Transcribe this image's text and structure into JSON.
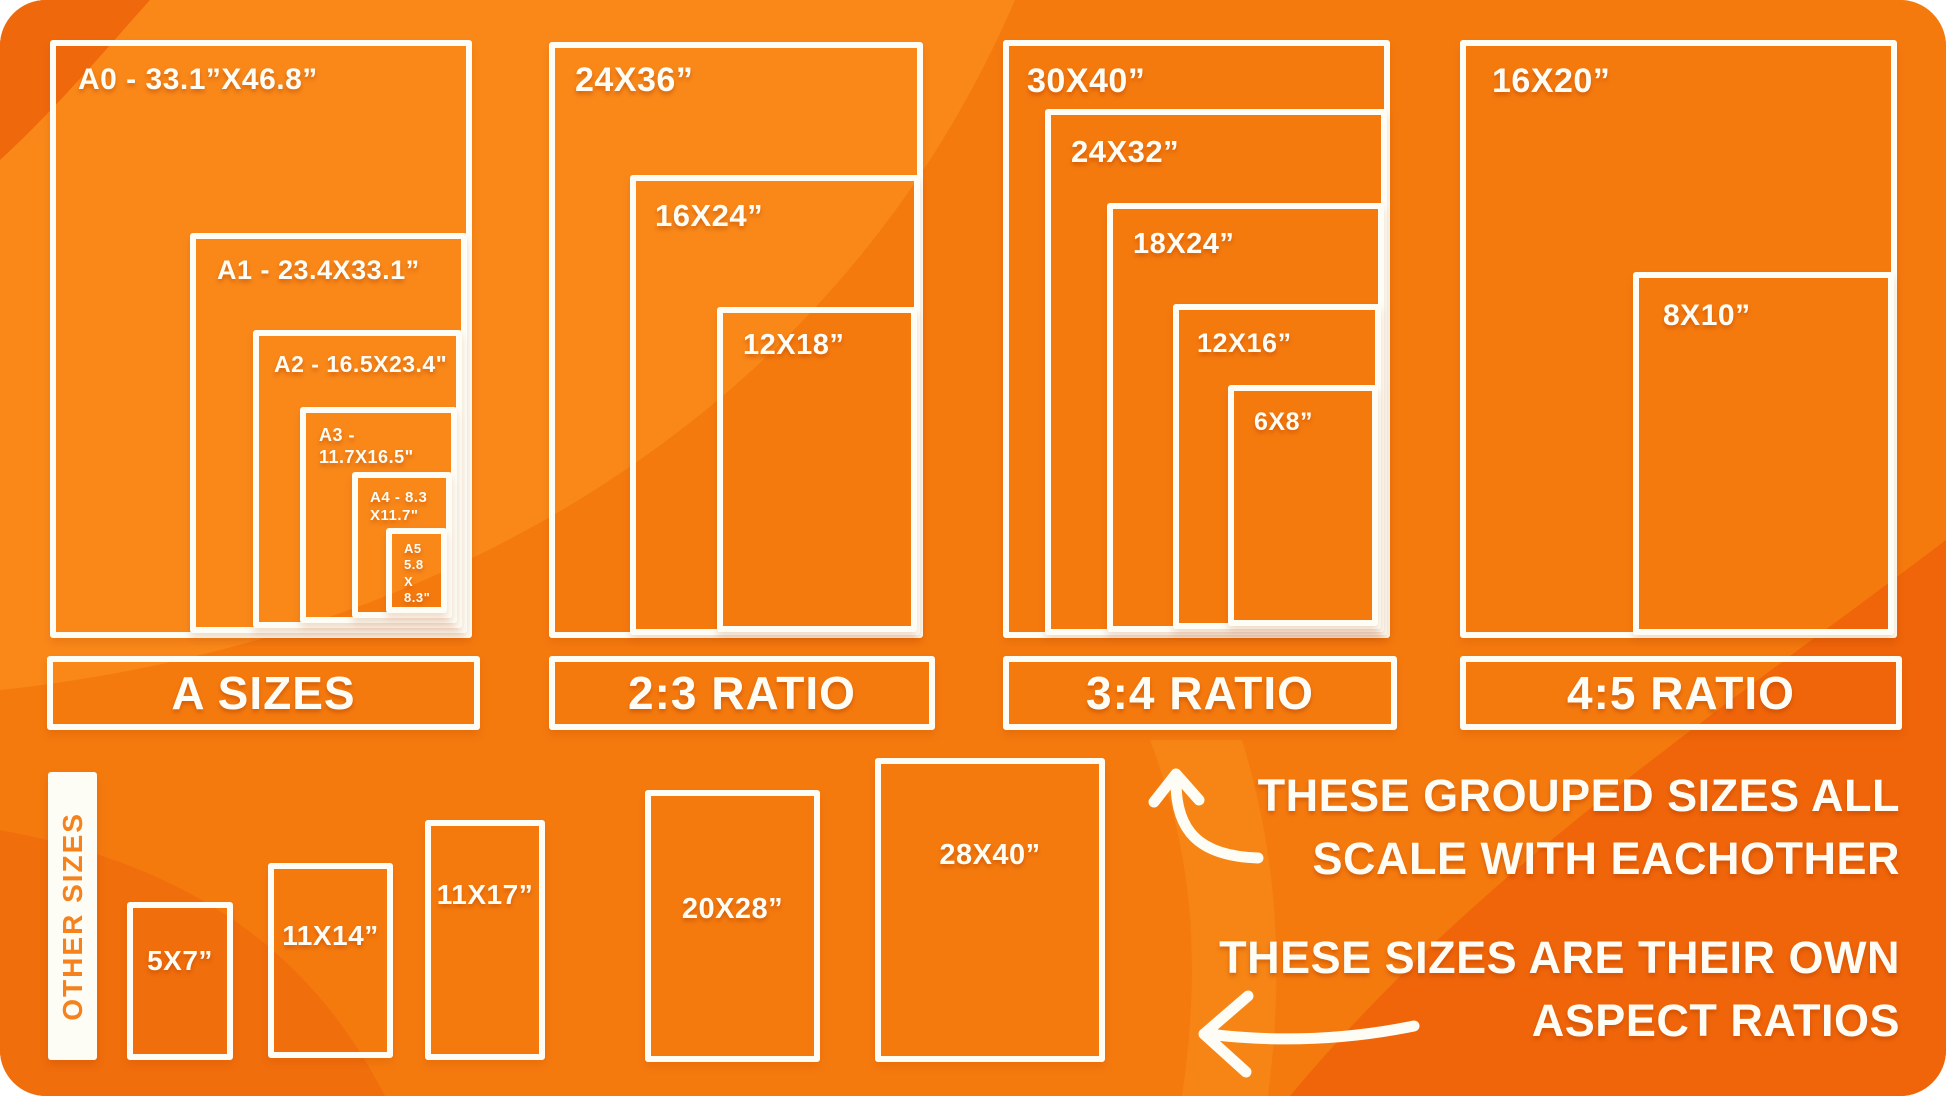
{
  "title": "Print size comparison infographic",
  "colors": {
    "base_orange": "#f57a0e",
    "light_orange": "#f9901f",
    "dark_orange": "#ee6409",
    "stroke_white": "#fdfdf6",
    "tab_text_orange": "#f5821c"
  },
  "groups": [
    {
      "label": "A SIZES",
      "boxes": [
        {
          "name": "a0",
          "label": "A0 - 33.1”X46.8”"
        },
        {
          "name": "a1",
          "label": "A1 - 23.4X33.1”"
        },
        {
          "name": "a2",
          "label": "A2 - 16.5X23.4\""
        },
        {
          "name": "a3",
          "label": "A3 - 11.7X16.5\""
        },
        {
          "name": "a4",
          "label": "A4 - 8.3\nX11.7\""
        },
        {
          "name": "a5",
          "label": "A5\n5.8\nX\n8.3\""
        }
      ]
    },
    {
      "label": "2:3 RATIO",
      "boxes": [
        {
          "name": "24x36",
          "label": "24X36”"
        },
        {
          "name": "16x24",
          "label": "16X24”"
        },
        {
          "name": "12x18",
          "label": "12X18”"
        }
      ]
    },
    {
      "label": "3:4 RATIO",
      "boxes": [
        {
          "name": "30x40",
          "label": "30X40”"
        },
        {
          "name": "24x32",
          "label": "24X32”"
        },
        {
          "name": "18x24",
          "label": "18X24”"
        },
        {
          "name": "12x16",
          "label": "12X16”"
        },
        {
          "name": "6x8",
          "label": "6X8”"
        }
      ]
    },
    {
      "label": "4:5 RATIO",
      "boxes": [
        {
          "name": "16x20",
          "label": "16X20”"
        },
        {
          "name": "8x10",
          "label": "8X10”"
        }
      ]
    }
  ],
  "other_sizes": {
    "label": "OTHER SIZES",
    "boxes": [
      {
        "name": "5x7",
        "label": "5X7”"
      },
      {
        "name": "11x14",
        "label": "11X14”"
      },
      {
        "name": "11x17",
        "label": "11X17”"
      },
      {
        "name": "20x28",
        "label": "20X28”"
      },
      {
        "name": "28x40",
        "label": "28X40”"
      }
    ]
  },
  "annotations": {
    "grouped_line1": "THESE GROUPED SIZES ALL",
    "grouped_line2": "SCALE WITH EACHOTHER",
    "own_line1": "THESE SIZES ARE THEIR OWN",
    "own_line2": "ASPECT RATIOS"
  },
  "icons": {
    "up_arrow": "curved-up-arrow",
    "left_arrow": "left-arrow"
  }
}
